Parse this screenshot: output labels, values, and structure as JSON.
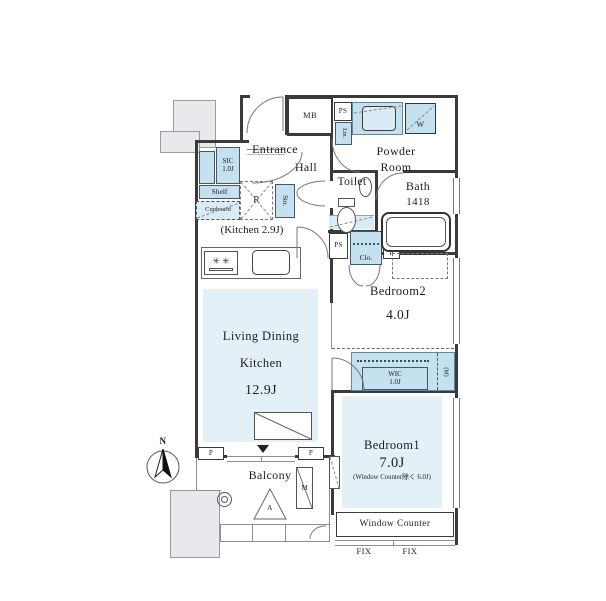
{
  "colors": {
    "room_fill": "#e4f0f8",
    "fixture_fill": "#c5e0ef",
    "wall": "#3a3a3a",
    "line": "#777777"
  },
  "compass": {
    "north_label": "N"
  },
  "rooms": {
    "entrance": {
      "label": "Entrance"
    },
    "hall": {
      "label": "Hall"
    },
    "powder_room": {
      "label": "Powder\nRoom"
    },
    "toilet": {
      "label": "Toilet"
    },
    "bath": {
      "label": "Bath",
      "size": "1418"
    },
    "bedroom2": {
      "label": "Bedroom2",
      "size": "4.0J"
    },
    "ldk": {
      "line1": "Living Dining",
      "line2": "Kitchen",
      "size": "12.9J"
    },
    "kitchen_note": "(Kitchen 2.9J)",
    "bedroom1": {
      "label": "Bedroom1",
      "size": "7.0J",
      "note": "(Window Counter除く 6.0J)"
    },
    "balcony": {
      "label": "Balcony"
    },
    "window_counter": {
      "label": "Window Counter"
    },
    "fix_left": "FIX",
    "fix_right": "FIX"
  },
  "fixtures": {
    "meter_box": "MB",
    "pipe_space_top": "PS",
    "linen": "Lin.",
    "washer": "W",
    "shoe_closet": "SIC\n1.0J",
    "shelf": "Shelf",
    "cupboard": "Cupboard",
    "refrigerator": "R",
    "storage": "Sto.",
    "pipe_space_mid": "PS",
    "closet": "Clo.",
    "pipe_small": "P",
    "wic": "WIC\n1.0J",
    "meter_strip": "(M)",
    "pillar_left": "P",
    "pillar_right": "P",
    "ac_outdoor_unit": "A",
    "balcony_m": "M",
    "stove_burners": "✳ ✳"
  }
}
